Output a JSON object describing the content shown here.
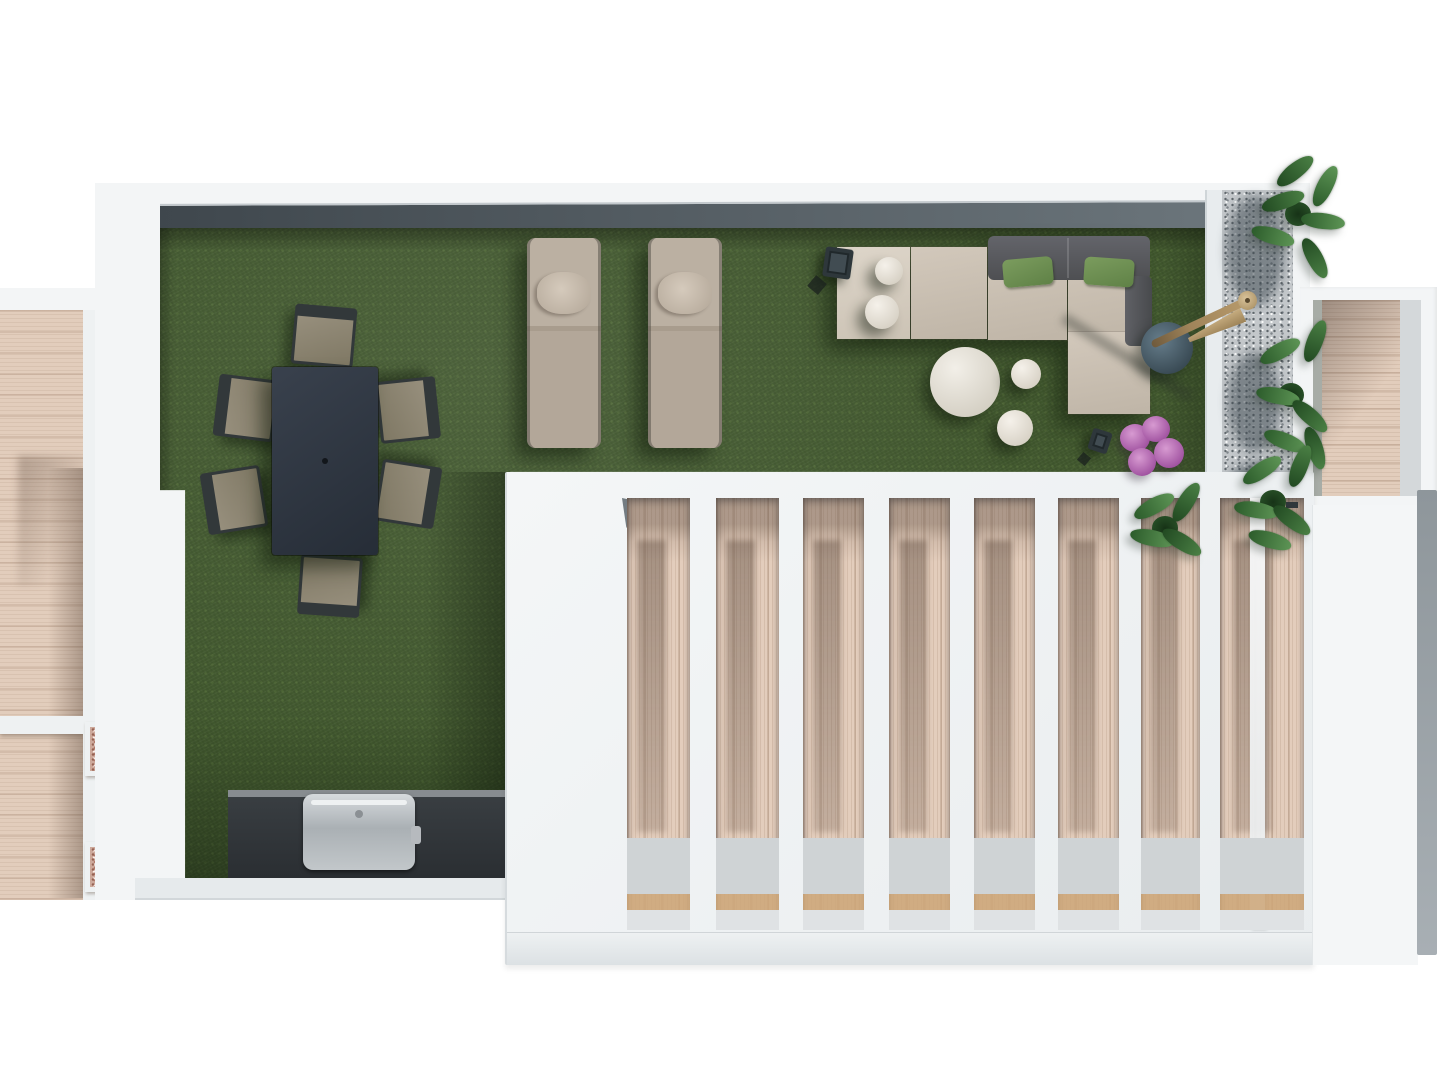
{
  "scene": {
    "type": "architectural-3d-floor-plan-render",
    "view": "top-down rooftop terrace",
    "visible_text": "none"
  },
  "palette": {
    "bg": "#ffffff",
    "wallWhite": "#f3f5f6",
    "wallShade": "#dde2e5",
    "wallDark": "#4e585e",
    "turf": "#41582e",
    "deckWood": "#e2cdbc",
    "pergolaWood": "#e3cdbc",
    "gravel": "#c3c7ca",
    "pebble": "#cda99b",
    "tableDark": "#2c333d",
    "chairSeat": "#8f8872",
    "chairFrame": "#32383a",
    "loungerBeige": "#b4a89a",
    "sofaBeige": "#c9bfb2",
    "backCushion": "#595a5c",
    "greenPillow": "#6e9053",
    "poufWhite": "#efeae2",
    "sideTableBlue": "#4f6472",
    "umbrellaWood": "#a0845a",
    "counterDark": "#33383c",
    "grillSilver": "#b9bdc0",
    "plantGreen": "#3a6b38",
    "plantPurple": "#b872b4"
  },
  "areas": [
    {
      "label": "main roof terrace",
      "surface": "artificial turf"
    },
    {
      "label": "left neighbour terrace",
      "surface": "wood deck with two pebble planter boxes"
    },
    {
      "label": "right neighbour terrace",
      "surface": "wood deck"
    },
    {
      "label": "pergola slatted roof",
      "openings": 8,
      "surface": "white concrete over wood-clad patio"
    },
    {
      "label": "gravel planter strip",
      "plants": 3
    }
  ],
  "furniture": [
    {
      "label": "dining table",
      "seats": 6,
      "finish": "dark anthracite"
    },
    {
      "label": "dining chair",
      "count": 6
    },
    {
      "label": "sun lounger with pillow",
      "count": 2
    },
    {
      "label": "L-shaped lounge sofa",
      "green_pillows": 2,
      "gray_back_cushions": 3
    },
    {
      "label": "round pouf",
      "count": 4
    },
    {
      "label": "round coffee table",
      "count": 1
    },
    {
      "label": "round side table",
      "count": 1
    },
    {
      "label": "closed tilted parasol",
      "count": 1
    },
    {
      "label": "candle lantern",
      "count": 2
    },
    {
      "label": "bbq grill counter",
      "count": 1
    },
    {
      "label": "green shrub",
      "count": 4
    },
    {
      "label": "purple shrub",
      "count": 1
    }
  ]
}
